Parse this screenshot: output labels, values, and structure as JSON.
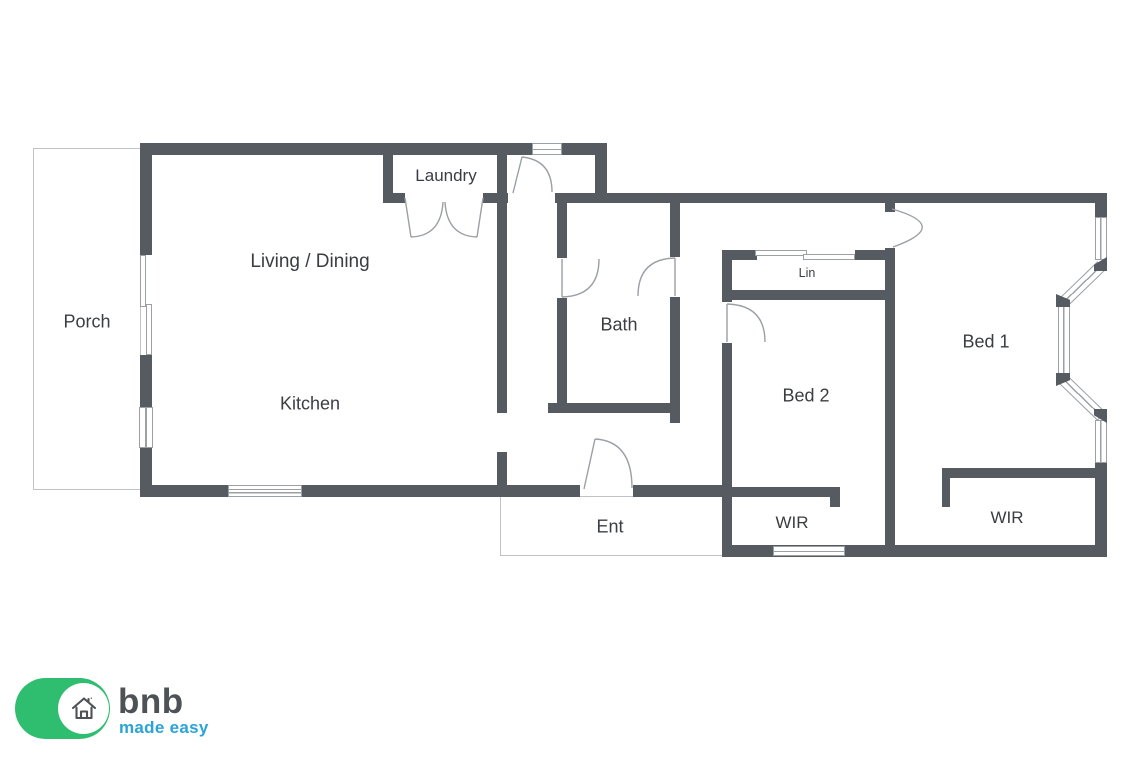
{
  "plan": {
    "rooms": [
      {
        "id": "porch",
        "label": "Porch"
      },
      {
        "id": "living",
        "label": "Living / Dining"
      },
      {
        "id": "laundry",
        "label": "Laundry"
      },
      {
        "id": "kitchen",
        "label": "Kitchen"
      },
      {
        "id": "bath",
        "label": "Bath"
      },
      {
        "id": "ent",
        "label": "Ent"
      },
      {
        "id": "lin",
        "label": "Lin"
      },
      {
        "id": "bed2",
        "label": "Bed 2"
      },
      {
        "id": "bed1",
        "label": "Bed 1"
      },
      {
        "id": "wir_bed2",
        "label": "WIR"
      },
      {
        "id": "wir_bed1",
        "label": "WIR"
      }
    ],
    "colors": {
      "wall": "#565b61",
      "thin_line": "#9aa0a4",
      "faint_outline": "#c0c3c5",
      "text": "#3a3e42"
    }
  },
  "logo": {
    "brand": "bnb",
    "tagline": "made easy",
    "colors": {
      "green": "#2fbe70",
      "blue": "#2aa3d8",
      "icon_gray": "#4d5256"
    }
  }
}
